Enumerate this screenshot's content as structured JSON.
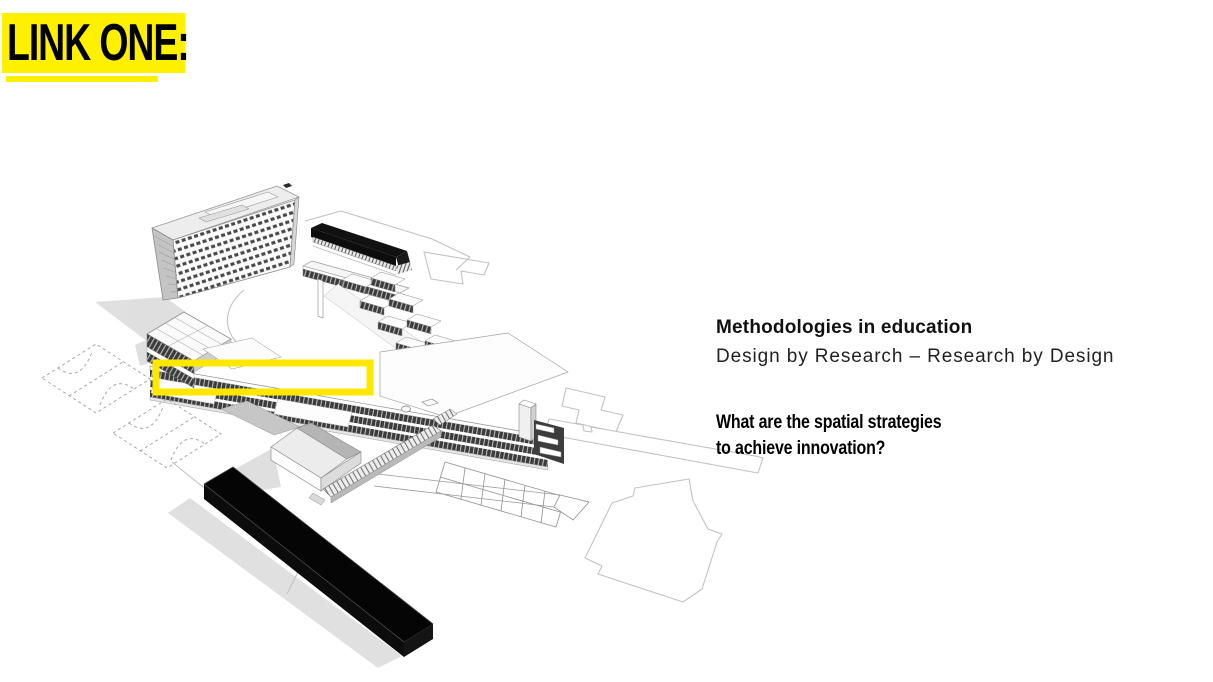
{
  "slide": {
    "background_color": "#ffffff",
    "badge": {
      "label": "LINK ONE:",
      "highlight_color": "#fff000",
      "text_color": "#000000"
    },
    "text_block": {
      "title": "Methodologies in education",
      "subtitle": "Design by Research – Research by Design",
      "question_lines": [
        "What are the spatial strategies",
        "to achieve innovation?"
      ]
    },
    "diagram": {
      "description": "Axonometric line drawing of a school campus",
      "highlight_rectangle_color": "#ffe800",
      "ink_color": "#3a3a3a",
      "shadow_color": "#d8d8d8",
      "parts": [
        "slab-tower-building",
        "black-roof-hall",
        "terraced-classroom-fins",
        "long-classroom-wing",
        "gridded-roof-studio",
        "gabled-gym",
        "long-staircase",
        "panelled-ramp",
        "black-bar-building",
        "dashed-sports-courts",
        "site-footprint-outlines",
        "highlight-rectangle"
      ]
    }
  }
}
